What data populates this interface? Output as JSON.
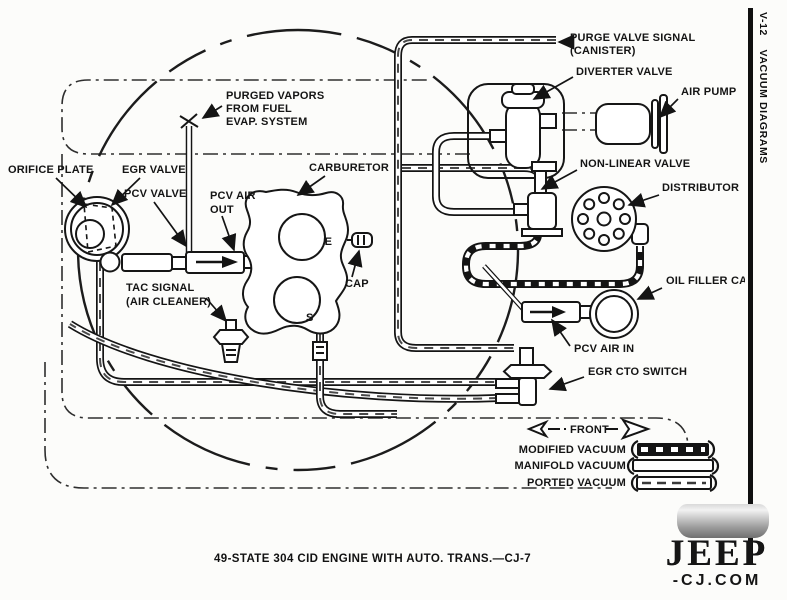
{
  "diagram": {
    "labels": {
      "purge_valve_signal": {
        "line1": "PURGE VALVE SIGNAL",
        "line2": "(CANISTER)"
      },
      "diverter_valve": "DIVERTER VALVE",
      "air_pump": "AIR PUMP",
      "purged_vapors": {
        "line1": "PURGED VAPORS",
        "line2": "FROM FUEL",
        "line3": "EVAP. SYSTEM"
      },
      "orifice_plate": "ORIFICE PLATE",
      "egr_valve": "EGR VALVE",
      "pcv_valve": "PCV VALVE",
      "pcv_air_out": {
        "line1": "PCV AIR",
        "line2": "OUT"
      },
      "carburetor": "CARBURETOR",
      "port_e": "E",
      "cap": "CAP",
      "port_s": "S",
      "tac_signal": {
        "line1": "TAC SIGNAL",
        "line2": "(AIR CLEANER)"
      },
      "non_linear_valve": "NON-LINEAR VALVE",
      "distributor": "DISTRIBUTOR",
      "oil_filler_cap": "OIL FILLER CAP",
      "pcv_air_in": "PCV AIR IN",
      "egr_cto_switch": "EGR CTO SWITCH",
      "front": "FRONT"
    },
    "legend": {
      "items": [
        {
          "label": "MODIFIED VACUUM",
          "style": "modified"
        },
        {
          "label": "MANIFOLD VACUUM",
          "style": "manifold"
        },
        {
          "label": "PORTED VACUUM",
          "style": "ported"
        }
      ]
    },
    "caption": "49-STATE 304 CID ENGINE WITH AUTO. TRANS.—CJ-7"
  },
  "sidebar": {
    "page_code": "V-12",
    "title": "VACUUM DIAGRAMS"
  },
  "watermark": {
    "brand": "JEEP",
    "suffix": "-CJ.COM"
  },
  "colors": {
    "ink": "#141414",
    "paper": "#fcfcfa"
  }
}
